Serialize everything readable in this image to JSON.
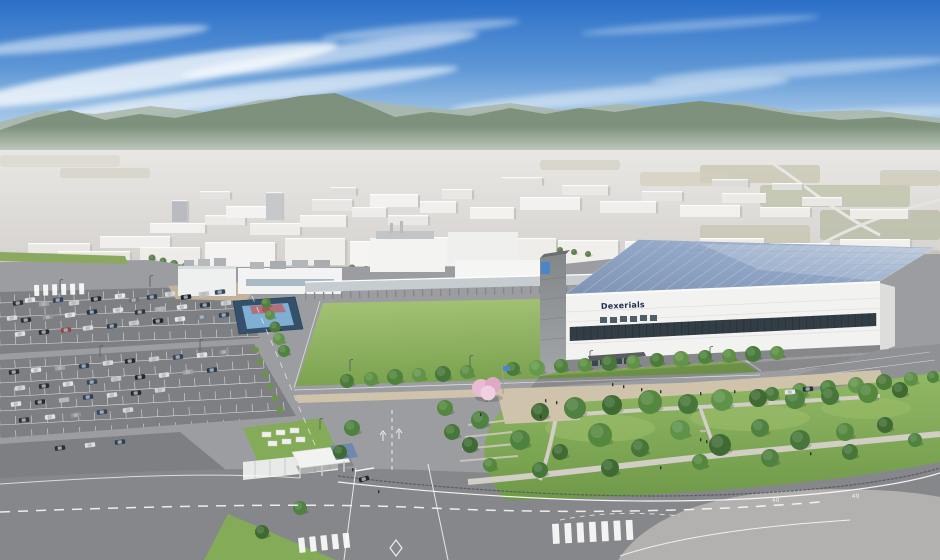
{
  "meta": {
    "scene_title": "Aerial CG rendering of a factory campus with solar-roof building, lawn field, parking lots and landscaped park"
  },
  "building": {
    "logo_text": "Dexerials"
  },
  "roads": {
    "speed_marking": "40"
  },
  "palette": {
    "lawn": "#84ab57",
    "lawn_light": "#a6c477",
    "park": "#83ac59",
    "road": "#9c9da0",
    "road_dark": "#86878a",
    "pavement": "#b2b1af",
    "asphalt": "#7e7f82",
    "facade": "#f2f2f0",
    "window_band": "#323d45",
    "wing": "#8b8f92",
    "solar_hi": "#b9c8db",
    "solar_lo": "#7e93b5",
    "court_outer": "#35506b",
    "court_inner": "#7fb0d4",
    "tan": "#cfc3ac",
    "dirt": "#c4b39b",
    "fence": "#53565a",
    "logo": "#1f2d52",
    "flag": "#4a86c8",
    "cherry": "#e7bcd2",
    "gate_roof": "#6f88ad",
    "sky_top": "#2b6fc8",
    "sky_horizon": "#e8f1f6",
    "mountain": "#7d917c"
  },
  "scene": {
    "clouds": [
      [
        150,
        75,
        190,
        14,
        -9,
        0.75
      ],
      [
        90,
        40,
        120,
        8,
        -6,
        0.5
      ],
      [
        330,
        55,
        150,
        9,
        -8,
        0.55
      ],
      [
        240,
        95,
        220,
        10,
        -7,
        0.6
      ],
      [
        420,
        30,
        100,
        6,
        -5,
        0.4
      ],
      [
        620,
        95,
        170,
        8,
        -5,
        0.45
      ],
      [
        800,
        70,
        150,
        7,
        -4,
        0.4
      ],
      [
        560,
        130,
        200,
        7,
        -3,
        0.5
      ],
      [
        860,
        115,
        120,
        6,
        -3,
        0.35
      ],
      [
        700,
        25,
        120,
        5,
        -4,
        0.3
      ]
    ],
    "farm_patches": [
      [
        700,
        165,
        120,
        18,
        "#c9c7b2",
        0.8
      ],
      [
        760,
        185,
        150,
        22,
        "#bfc3a9",
        0.8
      ],
      [
        640,
        172,
        90,
        14,
        "#d3cfbd",
        0.7
      ],
      [
        820,
        210,
        120,
        30,
        "#b9bda6",
        0.8
      ],
      [
        700,
        225,
        110,
        26,
        "#c6c3ae",
        0.7
      ],
      [
        540,
        160,
        80,
        10,
        "#cfccba",
        0.6
      ],
      [
        0,
        155,
        120,
        12,
        "#d8d5c8",
        0.6
      ],
      [
        60,
        168,
        90,
        10,
        "#cdcaba",
        0.5
      ],
      [
        860,
        250,
        80,
        25,
        "#c2bfae",
        0.8
      ],
      [
        880,
        170,
        60,
        16,
        "#ccc9b6",
        0.7
      ]
    ],
    "distant_buildings": [
      [
        100,
        236,
        70,
        12,
        "#efeeec"
      ],
      [
        28,
        243,
        62,
        10,
        "#e9e8e5"
      ],
      [
        150,
        223,
        55,
        10,
        "#f1f0ee"
      ],
      [
        172,
        200,
        15,
        22,
        "#b9bbc0"
      ],
      [
        205,
        215,
        40,
        10,
        "#eceae7"
      ],
      [
        226,
        206,
        42,
        12,
        "#f3f2f0"
      ],
      [
        266,
        192,
        16,
        28,
        "#c7c8cb"
      ],
      [
        250,
        223,
        50,
        12,
        "#eeedea"
      ],
      [
        300,
        215,
        46,
        12,
        "#f1efec"
      ],
      [
        312,
        199,
        40,
        12,
        "#e7e6e3"
      ],
      [
        352,
        207,
        34,
        10,
        "#edecea"
      ],
      [
        370,
        194,
        48,
        13,
        "#f2f1ef"
      ],
      [
        388,
        215,
        40,
        10,
        "#e9e8e6"
      ],
      [
        420,
        201,
        36,
        12,
        "#f0efed"
      ],
      [
        442,
        189,
        30,
        10,
        "#e8e7e4"
      ],
      [
        470,
        207,
        44,
        12,
        "#f2f1ee"
      ],
      [
        330,
        187,
        26,
        8,
        "#e0dfdd"
      ],
      [
        200,
        191,
        30,
        8,
        "#e4e3e1"
      ],
      [
        520,
        197,
        60,
        13,
        "#f2f1ef"
      ],
      [
        562,
        185,
        46,
        10,
        "#eae9e6"
      ],
      [
        600,
        201,
        56,
        12,
        "#efeeec"
      ],
      [
        642,
        191,
        40,
        10,
        "#e6e5e2"
      ],
      [
        680,
        205,
        60,
        12,
        "#f1f0ed"
      ],
      [
        722,
        193,
        44,
        10,
        "#eceae7"
      ],
      [
        760,
        207,
        50,
        10,
        "#eeede9"
      ],
      [
        802,
        197,
        40,
        9,
        "#e8e7e4"
      ],
      [
        850,
        209,
        58,
        10,
        "#edece9"
      ],
      [
        502,
        177,
        40,
        8,
        "#e2e1de"
      ],
      [
        712,
        179,
        36,
        8,
        "#dddcd9"
      ],
      [
        772,
        183,
        30,
        7,
        "#e0dfdc"
      ],
      [
        205,
        242,
        70,
        25,
        "#f4f3f1"
      ],
      [
        285,
        238,
        60,
        27,
        "#efeeeb"
      ],
      [
        350,
        241,
        80,
        26,
        "#f5f4f2"
      ],
      [
        432,
        237,
        68,
        30,
        "#f2f1ef"
      ],
      [
        502,
        238,
        54,
        27,
        "#eeede9"
      ],
      [
        558,
        240,
        60,
        24,
        "#f0efec"
      ],
      [
        625,
        241,
        70,
        24,
        "#f3f2ef"
      ],
      [
        700,
        238,
        64,
        22,
        "#ecebe8"
      ],
      [
        770,
        243,
        60,
        20,
        "#efeeeb"
      ],
      [
        840,
        239,
        70,
        22,
        "#f1f0ed"
      ],
      [
        140,
        247,
        60,
        18,
        "#edece9"
      ],
      [
        58,
        251,
        72,
        14,
        "#e9e8e5"
      ]
    ],
    "distant_trees": [
      [
        152,
        258,
        3.5
      ],
      [
        163,
        261,
        3.5
      ],
      [
        174,
        264,
        4
      ],
      [
        185,
        267,
        4
      ],
      [
        196,
        270,
        4
      ],
      [
        206,
        272,
        3.5
      ],
      [
        352,
        268,
        3.5
      ],
      [
        366,
        270,
        4
      ],
      [
        380,
        272,
        3.5
      ],
      [
        560,
        250,
        3
      ],
      [
        574,
        252,
        3
      ],
      [
        588,
        254,
        3
      ],
      [
        770,
        257,
        3
      ],
      [
        784,
        259,
        3
      ],
      [
        798,
        261,
        3
      ]
    ],
    "stall_rows_a": [
      [
        0,
        303,
        252,
        294,
        17
      ],
      [
        0,
        317,
        256,
        308,
        17
      ],
      [
        0,
        331,
        260,
        322,
        17
      ],
      [
        0,
        345,
        263,
        336,
        17
      ]
    ],
    "stall_rows_b": [
      [
        0,
        369,
        258,
        354,
        17
      ],
      [
        0,
        383,
        264,
        368,
        17
      ],
      [
        0,
        397,
        270,
        382,
        18
      ],
      [
        0,
        411,
        277,
        396,
        18
      ],
      [
        0,
        425,
        284,
        410,
        18
      ],
      [
        0,
        439,
        240,
        427,
        15
      ]
    ],
    "cars": [
      [
        18,
        303,
        "#2c3038"
      ],
      [
        30,
        300,
        "#e6e7e8"
      ],
      [
        44,
        304,
        "#9aa0a6"
      ],
      [
        58,
        300,
        "#31415a"
      ],
      [
        74,
        303,
        "#caccce"
      ],
      [
        96,
        299,
        "#23262b"
      ],
      [
        120,
        296,
        "#e8e9ea"
      ],
      [
        134,
        300,
        "#6d7377"
      ],
      [
        152,
        297,
        "#2f3f55"
      ],
      [
        170,
        294,
        "#d6d7d8"
      ],
      [
        186,
        297,
        "#1f2228"
      ],
      [
        204,
        294,
        "#c3c6c9"
      ],
      [
        220,
        292,
        "#384a5e"
      ],
      [
        12,
        318,
        "#d9dadb"
      ],
      [
        26,
        320,
        "#2b2e34"
      ],
      [
        48,
        317,
        "#8f959b"
      ],
      [
        70,
        315,
        "#e4e5e6"
      ],
      [
        92,
        312,
        "#243043"
      ],
      [
        118,
        310,
        "#dfe0e1"
      ],
      [
        140,
        312,
        "#33373d"
      ],
      [
        160,
        309,
        "#aab0b5"
      ],
      [
        182,
        307,
        "#e2e3e4"
      ],
      [
        205,
        305,
        "#2c3843"
      ],
      [
        226,
        303,
        "#cfd1d3"
      ],
      [
        20,
        334,
        "#e1e2e3"
      ],
      [
        44,
        332,
        "#262a31"
      ],
      [
        66,
        330,
        "#8d4a42"
      ],
      [
        88,
        328,
        "#d8d9da"
      ],
      [
        112,
        326,
        "#2e3e52"
      ],
      [
        134,
        323,
        "#c9ccce"
      ],
      [
        158,
        321,
        "#22252a"
      ],
      [
        180,
        319,
        "#e6e7e8"
      ],
      [
        202,
        317,
        "#777d84"
      ],
      [
        224,
        315,
        "#30435c"
      ],
      [
        14,
        372,
        "#2b2f36"
      ],
      [
        36,
        370,
        "#e3e4e5"
      ],
      [
        60,
        368,
        "#9ba1a7"
      ],
      [
        84,
        366,
        "#2e3c50"
      ],
      [
        108,
        363,
        "#dadbdc"
      ],
      [
        130,
        361,
        "#24272d"
      ],
      [
        154,
        359,
        "#cdd0d2"
      ],
      [
        178,
        357,
        "#374357"
      ],
      [
        202,
        355,
        "#e5e6e7"
      ],
      [
        224,
        352,
        "#8a9096"
      ],
      [
        20,
        388,
        "#d7d8d9"
      ],
      [
        44,
        386,
        "#2a2d33"
      ],
      [
        68,
        384,
        "#e2e3e4"
      ],
      [
        92,
        382,
        "#32465e"
      ],
      [
        116,
        379,
        "#c6c9cb"
      ],
      [
        140,
        377,
        "#212429"
      ],
      [
        164,
        375,
        "#dfe0e1"
      ],
      [
        188,
        372,
        "#9aa0a5"
      ],
      [
        212,
        370,
        "#2d3a4e"
      ],
      [
        16,
        404,
        "#e4e5e6"
      ],
      [
        40,
        402,
        "#272b31"
      ],
      [
        64,
        400,
        "#b9bcbf"
      ],
      [
        88,
        397,
        "#2f4058"
      ],
      [
        112,
        395,
        "#dcddde"
      ],
      [
        136,
        393,
        "#25282e"
      ],
      [
        160,
        390,
        "#d0d2d4"
      ],
      [
        24,
        420,
        "#2c3037"
      ],
      [
        50,
        417,
        "#e1e2e3"
      ],
      [
        76,
        415,
        "#8e9499"
      ],
      [
        102,
        412,
        "#33455c"
      ],
      [
        128,
        410,
        "#d5d6d7"
      ],
      [
        60,
        448,
        "#2a2e34"
      ],
      [
        90,
        445,
        "#dedfe0"
      ],
      [
        120,
        442,
        "#31404f"
      ],
      [
        790,
        392,
        "#e8e8e8",
        -4
      ],
      [
        808,
        389,
        "#2c3340",
        -4
      ],
      [
        364,
        479,
        "#24272c",
        -16
      ]
    ],
    "street_trees": [
      [
        347,
        381,
        7,
        "#4c7a38"
      ],
      [
        371,
        379,
        7,
        "#5d8f44"
      ],
      [
        395,
        377,
        8,
        "#4f833c"
      ],
      [
        419,
        375,
        7,
        "#63944a"
      ],
      [
        443,
        374,
        8,
        "#47763a"
      ],
      [
        467,
        372,
        7,
        "#5d8f44"
      ],
      [
        513,
        369,
        7,
        "#4c7a38"
      ],
      [
        537,
        368,
        8,
        "#639a4b"
      ],
      [
        561,
        366,
        7,
        "#4f833c"
      ],
      [
        585,
        365,
        7,
        "#5d8f44"
      ],
      [
        609,
        363,
        8,
        "#47763a"
      ],
      [
        633,
        362,
        7,
        "#5f9247"
      ],
      [
        657,
        360,
        7,
        "#4c7a38"
      ],
      [
        681,
        359,
        8,
        "#63944a"
      ],
      [
        705,
        357,
        7,
        "#4f833c"
      ],
      [
        729,
        356,
        7,
        "#5d8f44"
      ],
      [
        753,
        354,
        8,
        "#487a3b"
      ],
      [
        777,
        353,
        7,
        "#5d8f44"
      ]
    ],
    "road_trees": [
      [
        266,
        303,
        5,
        "#4f833c"
      ],
      [
        270,
        315,
        5,
        "#5d8f44"
      ],
      [
        275,
        327,
        5.5,
        "#4c7a38"
      ],
      [
        279,
        339,
        6,
        "#63944a"
      ],
      [
        284,
        351,
        6,
        "#4f833c"
      ],
      [
        772,
        394,
        7,
        "#487a3b"
      ],
      [
        800,
        391,
        8,
        "#5d8f44"
      ],
      [
        828,
        388,
        8,
        "#4f833c"
      ],
      [
        856,
        385,
        8,
        "#63944a"
      ],
      [
        884,
        382,
        8,
        "#4c7a38"
      ],
      [
        911,
        379,
        7,
        "#5d8f44"
      ],
      [
        933,
        377,
        6,
        "#4f833c"
      ]
    ],
    "park_trees": [
      [
        540,
        412,
        9,
        "#3f6b33"
      ],
      [
        575,
        408,
        11,
        "#4f8140"
      ],
      [
        612,
        405,
        10,
        "#3f6b33"
      ],
      [
        650,
        402,
        12,
        "#55883f"
      ],
      [
        688,
        404,
        10,
        "#47763a"
      ],
      [
        722,
        400,
        11,
        "#5f934a"
      ],
      [
        758,
        398,
        9,
        "#3f6b33"
      ],
      [
        795,
        399,
        10,
        "#4f8140"
      ],
      [
        830,
        396,
        9,
        "#47763a"
      ],
      [
        868,
        393,
        10,
        "#55883f"
      ],
      [
        900,
        390,
        8,
        "#3f6b33"
      ],
      [
        520,
        440,
        10,
        "#4f8140"
      ],
      [
        560,
        452,
        8,
        "#3f6b33"
      ],
      [
        600,
        435,
        12,
        "#55883f"
      ],
      [
        640,
        448,
        9,
        "#47763a"
      ],
      [
        680,
        430,
        10,
        "#5f934a"
      ],
      [
        720,
        445,
        11,
        "#3f6b33"
      ],
      [
        760,
        428,
        9,
        "#4f8140"
      ],
      [
        800,
        440,
        10,
        "#47763a"
      ],
      [
        845,
        432,
        9,
        "#55883f"
      ],
      [
        885,
        425,
        8,
        "#3f6b33"
      ],
      [
        915,
        440,
        7,
        "#4f8140"
      ],
      [
        540,
        470,
        8,
        "#47763a"
      ],
      [
        610,
        468,
        9,
        "#3f6b33"
      ],
      [
        700,
        462,
        8,
        "#55883f"
      ],
      [
        770,
        458,
        9,
        "#4f8140"
      ],
      [
        850,
        452,
        8,
        "#47763a"
      ],
      [
        480,
        420,
        9,
        "#4f8140"
      ],
      [
        470,
        445,
        8,
        "#3f6b33"
      ],
      [
        490,
        465,
        7,
        "#55883f"
      ],
      [
        352,
        428,
        8,
        "#4f8140"
      ],
      [
        340,
        452,
        7,
        "#3f6b33"
      ],
      [
        445,
        408,
        8,
        "#55883f"
      ],
      [
        452,
        432,
        8,
        "#47763a"
      ],
      [
        300,
        508,
        7,
        "#4f8140"
      ],
      [
        262,
        532,
        7,
        "#3f6b33"
      ]
    ],
    "bushes": [
      [
        256,
        350,
        3
      ],
      [
        260,
        362,
        3
      ],
      [
        265,
        374,
        3.2
      ],
      [
        270,
        386,
        3.2
      ],
      [
        275,
        398,
        3.4
      ],
      [
        280,
        410,
        3.4
      ]
    ],
    "people": [
      [
        612,
        383
      ],
      [
        623,
        385
      ],
      [
        641,
        388
      ],
      [
        660,
        390
      ],
      [
        700,
        392
      ],
      [
        734,
        390
      ],
      [
        545,
        399
      ],
      [
        556,
        401
      ],
      [
        480,
        413
      ],
      [
        700,
        438
      ],
      [
        706,
        440
      ],
      [
        660,
        466
      ],
      [
        352,
        468
      ],
      [
        378,
        490
      ],
      [
        540,
        415
      ],
      [
        810,
        452
      ]
    ],
    "light_poles": [
      [
        350,
        371
      ],
      [
        470,
        367
      ],
      [
        590,
        362
      ],
      [
        710,
        358
      ],
      [
        60,
        291
      ],
      [
        150,
        287
      ],
      [
        100,
        357
      ],
      [
        200,
        351
      ],
      [
        320,
        430
      ]
    ],
    "crosswalks": [
      [
        552,
        524,
        86,
        20,
        -3,
        7
      ],
      [
        298,
        538,
        56,
        15,
        -6,
        5
      ],
      [
        34,
        285,
        54,
        11,
        -2,
        6
      ]
    ],
    "roof": {
      "bl": [
        566,
        294
      ],
      "br": [
        880,
        281
      ],
      "tl": [
        638,
        240
      ],
      "tr": [
        934,
        248
      ],
      "cols": 19,
      "rows": 6
    },
    "mullions": {
      "x1": 570,
      "x2": 876,
      "y1": 327,
      "y2": 313,
      "h1": 14,
      "h2": 13,
      "n": 44
    }
  }
}
